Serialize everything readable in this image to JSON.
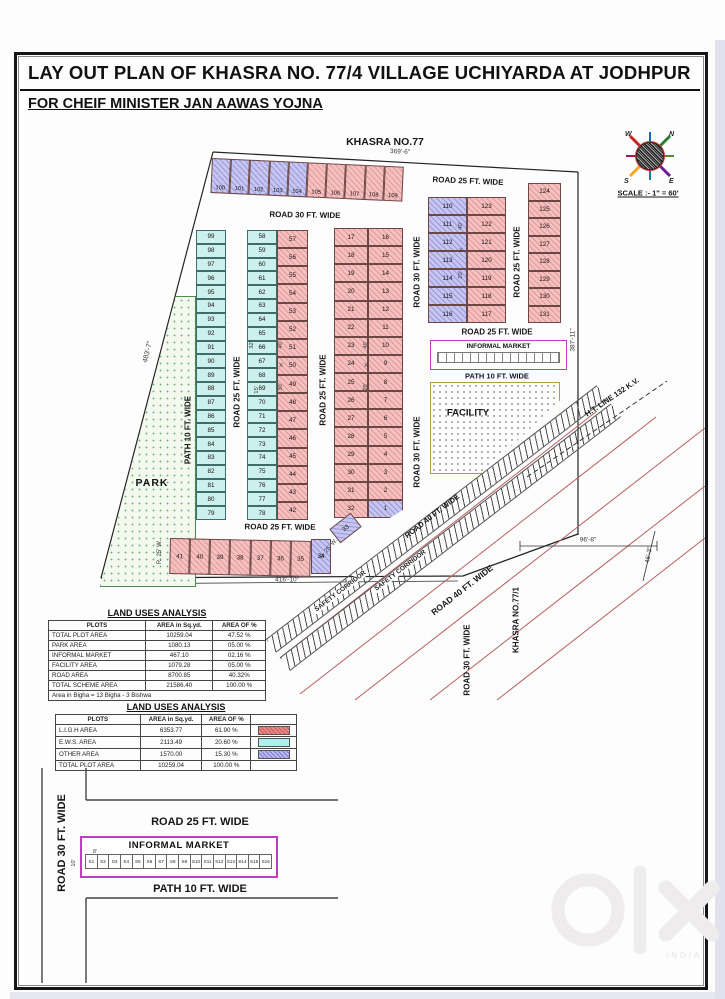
{
  "title": {
    "line1": "LAY OUT  PLAN OF  KHASRA  NO.  77/4 VILLAGE UCHIYARDA AT JODHPUR",
    "line2": "FOR CHEIF MINISTER JAN AAWAS YOJNA"
  },
  "compass": {
    "n": "N",
    "w": "W",
    "s": "S",
    "e": "E",
    "scale": "SCALE :- 1\" = 60'"
  },
  "plan": {
    "khasra_top": "KHASRA NO.77",
    "khasra_right": "KHASRA NO.77/1",
    "ht_line": "H.T. LINE 132 K.V.",
    "safety_corridor": "SAFETY CORRIDOR",
    "park": "PARK",
    "facility": "FACILITY",
    "informal_market": "INFORMAL MARKET",
    "labels": {
      "road25": "ROAD 25 FT. WIDE",
      "road30": "ROAD 30 FT. WIDE",
      "road40": "ROAD 40 FT. WIDE",
      "path10": "PATH 10 FT. WIDE",
      "r25w": "R. 25' W."
    },
    "dims": {
      "top": "369'-6\"",
      "left": "483'-7\"",
      "right": "387'-11\"",
      "bottom": "416'-10\"",
      "d96": "96'-8\"",
      "d46": "46'-3\"",
      "d20": "20'",
      "d40": "40'",
      "d30": "30'",
      "d15": "15'",
      "d32": "32'",
      "x": "X",
      "d10": "10'",
      "d8": "8'"
    },
    "plots": {
      "top_blue": [
        "100",
        "101",
        "102",
        "103",
        "104"
      ],
      "top_pink": [
        "105",
        "106",
        "107",
        "108",
        "109"
      ],
      "col_a": [
        "99",
        "98",
        "97",
        "96",
        "95",
        "94",
        "93",
        "92",
        "91",
        "90",
        "89",
        "88",
        "87",
        "86",
        "85",
        "84",
        "83",
        "82",
        "81",
        "80",
        "79"
      ],
      "col_b_left": [
        "58",
        "59",
        "60",
        "61",
        "62",
        "63",
        "64",
        "65",
        "66",
        "67",
        "68",
        "69",
        "70",
        "71",
        "72",
        "73",
        "74",
        "75",
        "76",
        "77",
        "78"
      ],
      "col_b_right": [
        "57",
        "56",
        "55",
        "54",
        "53",
        "52",
        "51",
        "50",
        "49",
        "48",
        "47",
        "46",
        "45",
        "44",
        "43",
        "42"
      ],
      "col_c_left": [
        "17",
        "18",
        "19",
        "20",
        "21",
        "22",
        "23",
        "24",
        "25",
        "26",
        "27",
        "28",
        "29",
        "30",
        "31",
        "32"
      ],
      "col_c_right": [
        "16",
        "15",
        "14",
        "13",
        "12",
        "11",
        "10",
        "9",
        "8",
        "7",
        "6",
        "5",
        "4",
        "3",
        "2"
      ],
      "plot1": "1",
      "block_d_blue": [
        "110",
        "111",
        "112",
        "113",
        "114",
        "115",
        "116"
      ],
      "block_d_pink": [
        "123",
        "122",
        "121",
        "120",
        "119",
        "118",
        "117"
      ],
      "col_e": [
        "124",
        "125",
        "126",
        "127",
        "128",
        "129",
        "130",
        "131"
      ],
      "bottom_row": [
        "41",
        "40",
        "39",
        "38",
        "37",
        "36",
        "35"
      ],
      "plot34": "34",
      "plot33": "33"
    }
  },
  "table1": {
    "title": "LAND USES ANALYSIS",
    "headers": [
      "PLOTS",
      "AREA in Sq.yd.",
      "AREA OF %"
    ],
    "rows": [
      {
        "name": "TOTAL PLOT AREA",
        "area": "10259.04",
        "pct": "47.52 %"
      },
      {
        "name": "PARK  AREA",
        "area": "1080.13",
        "pct": "05.00 %"
      },
      {
        "name": "INFORMAL MARKET",
        "area": "467.10",
        "pct": "02.16 %"
      },
      {
        "name": "FACILITY  AREA",
        "area": "1079.28",
        "pct": "05.00 %"
      },
      {
        "name": "ROAD AREA",
        "area": "8700.85",
        "pct": "40.32%"
      },
      {
        "name": "TOTAL SCHEME AREA",
        "area": "21586.40",
        "pct": "100.00 %"
      }
    ],
    "note": "Area in Bigha = 13 Bigha - 3 Bishwa"
  },
  "table2": {
    "title": "LAND USES ANALYSIS",
    "headers": [
      "PLOTS",
      "AREA in Sq.yd.",
      "AREA OF %"
    ],
    "rows": [
      {
        "name": "L.I.G.H  AREA",
        "area": "6353.77",
        "pct": "61.90 %"
      },
      {
        "name": "E.W.S.  AREA",
        "area": "2113.49",
        "pct": "20.60 %"
      },
      {
        "name": "OTHER  AREA",
        "area": "1570.00",
        "pct": "15.30 %"
      },
      {
        "name": "TOTAL PLOT AREA",
        "area": "10259.04",
        "pct": "100.00 %"
      }
    ]
  },
  "detail": {
    "road30": "ROAD 30 FT. WIDE",
    "road25": "ROAD 25 FT. WIDE",
    "market": "INFORMAL MARKET",
    "path10": "PATH 10 FT. WIDE",
    "stalls": [
      "S1",
      "S2",
      "S3",
      "S4",
      "S5",
      "S6",
      "S7",
      "S8",
      "S9",
      "S10",
      "S11",
      "S12",
      "S13",
      "S14",
      "S15",
      "S16"
    ]
  },
  "watermark": {
    "brand": "olx",
    "sub": "INDIA"
  }
}
